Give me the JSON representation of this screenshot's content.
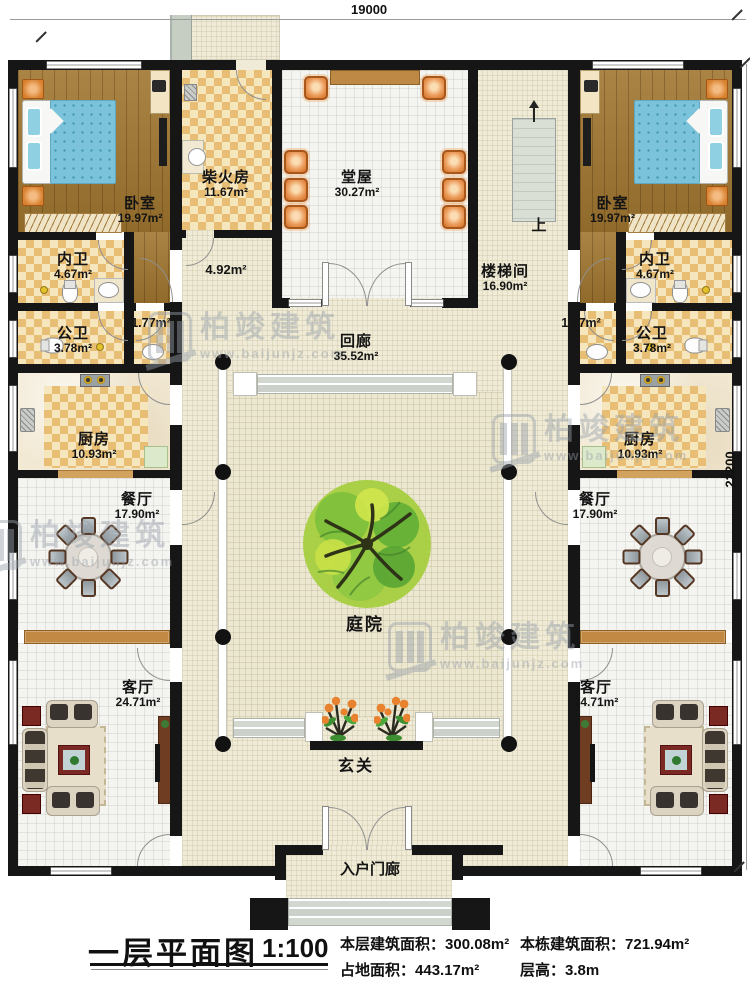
{
  "dimensions": {
    "width": "19000",
    "height": "22200"
  },
  "rooms": {
    "bedroom_left": {
      "name": "卧室",
      "area": "19.97m²"
    },
    "bedroom_right": {
      "name": "卧室",
      "area": "19.97m²"
    },
    "firewood_room": {
      "name": "柴火房",
      "area": "11.67m²"
    },
    "main_hall": {
      "name": "堂屋",
      "area": "30.27m²"
    },
    "stairwell": {
      "name": "楼梯间",
      "area": "16.90m²"
    },
    "stair_up": {
      "name": "上"
    },
    "passage": {
      "area": "4.92m²"
    },
    "corridor": {
      "name": "回廊",
      "area": "35.52m²"
    },
    "inner_bath_left": {
      "name": "内卫",
      "area": "4.67m²"
    },
    "inner_bath_right": {
      "name": "内卫",
      "area": "4.67m²"
    },
    "small_pass_left": {
      "area": "1.77m²"
    },
    "small_pass_right": {
      "area": "1.77m²"
    },
    "public_bath_left": {
      "name": "公卫",
      "area": "3.78m²"
    },
    "public_bath_right": {
      "name": "公卫",
      "area": "3.78m²"
    },
    "kitchen_left": {
      "name": "厨房",
      "area": "10.93m²"
    },
    "kitchen_right": {
      "name": "厨房",
      "area": "10.93m²"
    },
    "dining_left": {
      "name": "餐厅",
      "area": "17.90m²"
    },
    "dining_right": {
      "name": "餐厅",
      "area": "17.90m²"
    },
    "courtyard": {
      "name": "庭院"
    },
    "living_left": {
      "name": "客厅",
      "area": "24.71m²"
    },
    "living_right": {
      "name": "客厅",
      "area": "24.71m²"
    },
    "foyer": {
      "name": "玄关"
    },
    "porch": {
      "name": "入户门廊"
    }
  },
  "caption": {
    "title": "一层平面图",
    "scale": "1:100",
    "stats": [
      {
        "label": "本层建筑面积：",
        "value": "300.08m²"
      },
      {
        "label": "本栋建筑面积：",
        "value": "721.94m²"
      },
      {
        "label": "占地面积：",
        "value": "443.17m²"
      },
      {
        "label": "层高：",
        "value": "3.8m"
      }
    ]
  },
  "watermark": {
    "brand": "柏竣建筑",
    "url": "www.baijunjz.com"
  },
  "colors": {
    "wall": "#161616",
    "floor_cream": "#EFEBD6",
    "checker": "#E7BE74",
    "wood": "#A0762F",
    "bed": "#7AC3DA",
    "hall_chair": "#E08A43",
    "tree": "#6FB83C",
    "watermark": "#98A1AB"
  }
}
